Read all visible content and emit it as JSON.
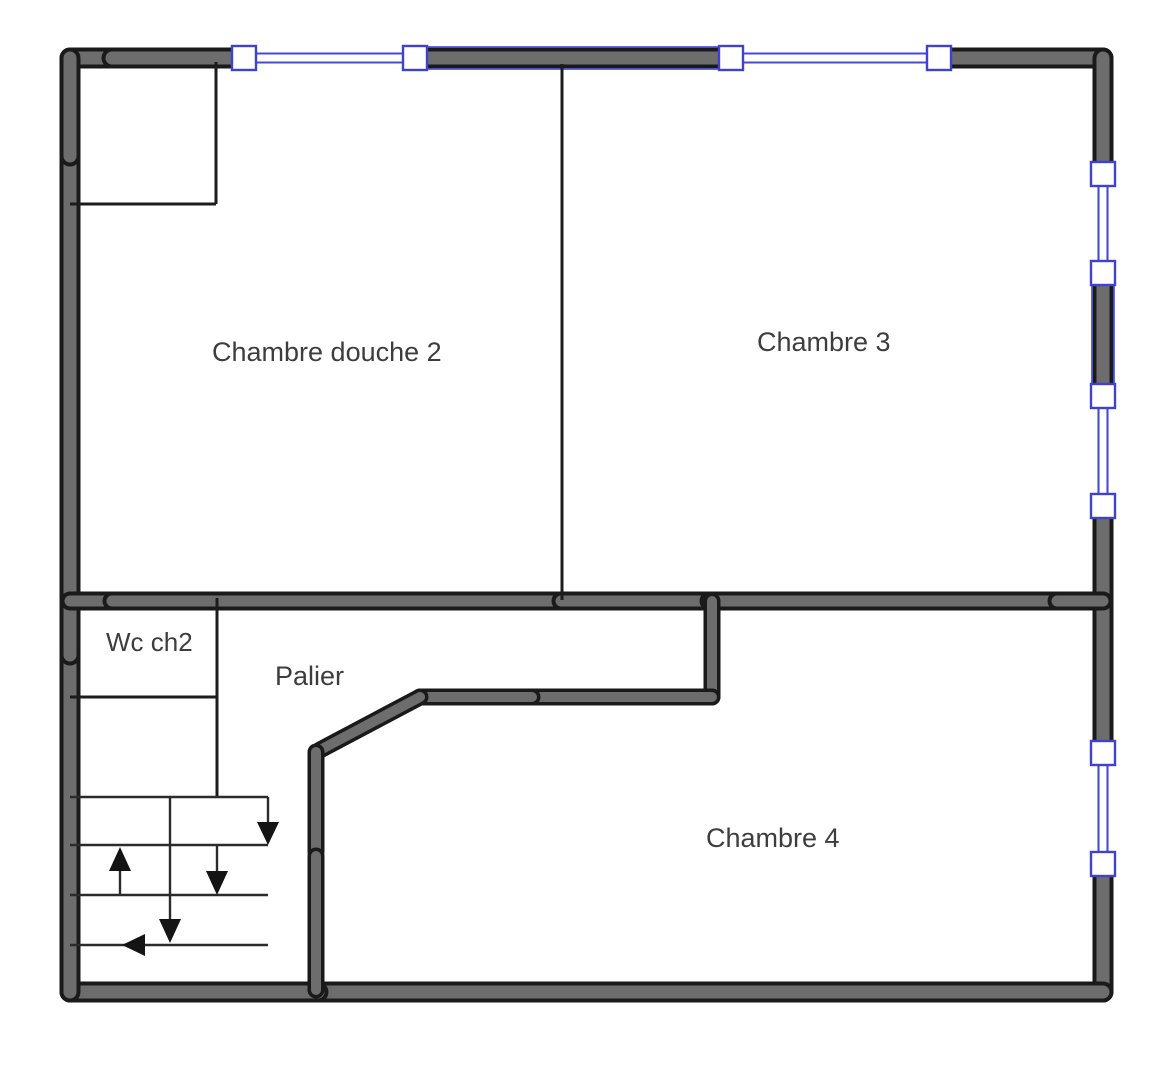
{
  "plan": {
    "type": "floor-plan",
    "rooms": [
      {
        "label": "Chambre douche 2"
      },
      {
        "label": "Chambre 3"
      },
      {
        "label": "Wc ch2"
      },
      {
        "label": "Palier"
      },
      {
        "label": "Chambre 4"
      }
    ],
    "windows": {
      "top_wall_count": 2,
      "right_wall_count": 3
    },
    "stairs": {
      "down_arrows": 3,
      "up_arrows": 1,
      "turn_arrows_left": 1
    },
    "colors": {
      "background": "#ffffff",
      "wall_fill": "#6d6d6d",
      "wall_outline": "#1a1a1a",
      "window_blue": "#474ad4",
      "label_text": "#3d3d3d"
    }
  }
}
